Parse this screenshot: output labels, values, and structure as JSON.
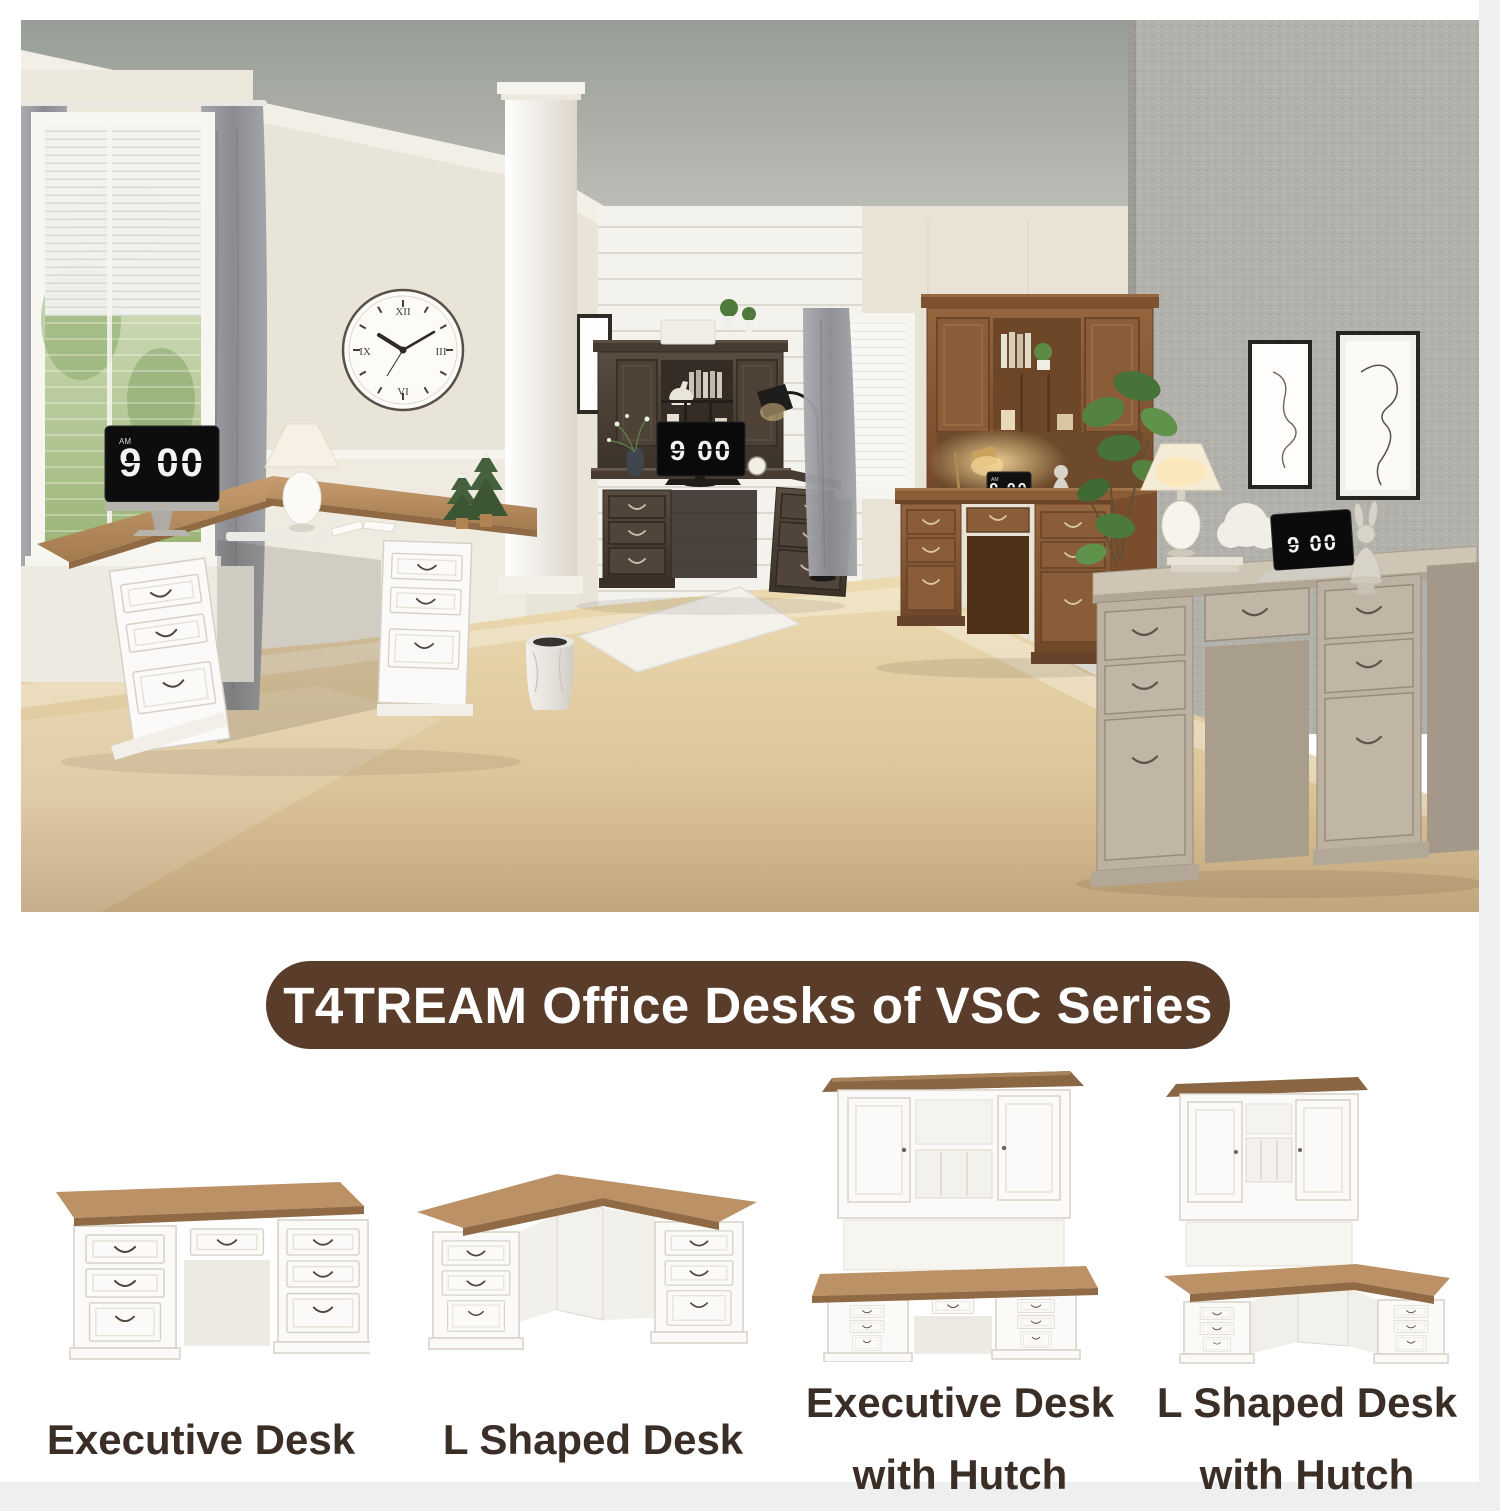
{
  "banner": {
    "text": "T4TREAM Office Desks of VSC Series"
  },
  "scene": {
    "flip_clock": {
      "display": "9 00",
      "period": "AM"
    },
    "wall_clock": {
      "numerals": [
        "XII",
        "III",
        "VI",
        "IX"
      ]
    }
  },
  "products": [
    {
      "id": "executive-desk",
      "line1": "Executive Desk",
      "line2": ""
    },
    {
      "id": "l-shaped-desk",
      "line1": "L Shaped Desk",
      "line2": ""
    },
    {
      "id": "executive-desk-with-hutch",
      "line1": "Executive Desk",
      "line2": "with Hutch"
    },
    {
      "id": "l-shaped-desk-with-hutch",
      "line1": "L Shaped Desk",
      "line2": "with Hutch"
    }
  ],
  "colors": {
    "page_bg": "#eef0f0",
    "banner_bg": "#5a3c2b",
    "banner_text": "#ffffff",
    "caption_text": "#3a2e26",
    "clock_bg": "#0d0d0d",
    "clock_digits": "#f4f4f2",
    "desk_top_wood": "#bb9165",
    "dark_desk": "#4a3f35",
    "brown_desk": "#8a5c38",
    "gray_desk": "#bdb2a2"
  }
}
